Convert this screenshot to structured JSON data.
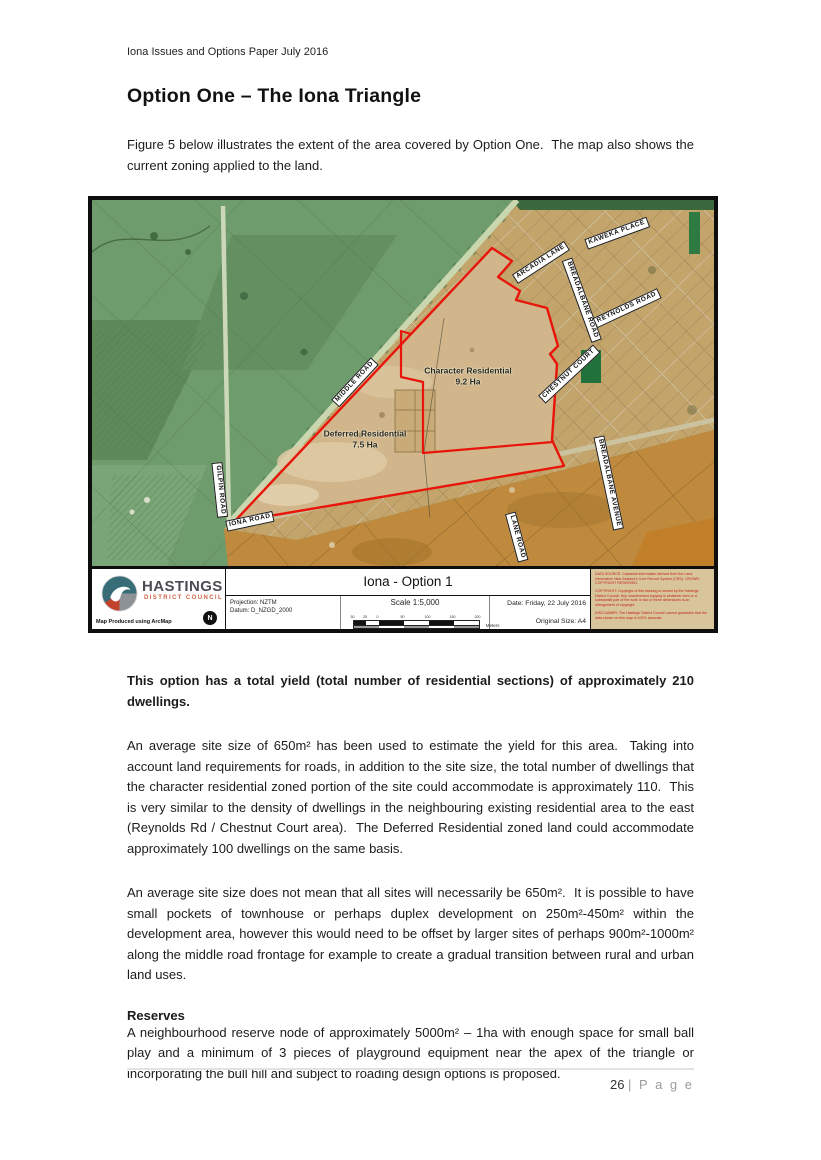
{
  "page": {
    "header": "Iona Issues and Options Paper July 2016",
    "title": "Option One – The Iona Triangle",
    "intro": "Figure 5 below illustrates the extent of the area covered by Option One.  The map also shows the current zoning applied to the land.",
    "footer": {
      "page_number": "26 ",
      "page_suffix": "| P a g e"
    }
  },
  "map": {
    "zone_labels": [
      {
        "name": "Character Residential",
        "area": "9.2 Ha"
      },
      {
        "name": "Deferred Residential",
        "area": "7.5 Ha"
      }
    ],
    "road_labels": [
      "MIDDLE ROAD",
      "GILPIN ROAD",
      "IONA ROAD",
      "LANE ROAD",
      "ARCADIA LANE",
      "KAWEKA PLACE",
      "BREADALBANE ROAD",
      "REYNOLDS ROAD",
      "CHESTNUT COURT",
      "BREADALBANE AVENUE"
    ],
    "footer": {
      "logo_title": "HASTINGS",
      "logo_subtitle": "DISTRICT COUNCIL",
      "produced": "Map Produced using ArcMap",
      "compass": "N",
      "projection": "Projection: NZTM",
      "datum": "Datum: D_NZGD_2000",
      "title": "Iona - Option 1",
      "scale": "Scale 1:5,000",
      "scale_ticks": [
        "50",
        "25",
        "0",
        "50",
        "100",
        "150",
        "200"
      ],
      "scale_units": "Meters",
      "date": "Date: Friday, 22 July 2016",
      "original_size": "Original Size: A4",
      "data_source": "DATA SOURCE: Cadastral information derived from the Land Information New Zealand's Core Record System (CRS). CROWN COPYRIGHT RESERVED.",
      "copyright": "COPYRIGHT: Copyright of this drawing is owned by the Hastings District Council. Any unauthorised copying in whatever form or a substantial part of the work in two or three dimensions is an infringement of copyright.",
      "disclaimer": "DISCLAIMER: The Hastings District Council cannot guarantee that the data shown on this map is 100% accurate."
    },
    "colors": {
      "rural_green": "#6f9c6c",
      "urban_tan": "#c3a46b",
      "triangle_fill": "#d2b68b",
      "rural_residential_orange": "#bf8a3e",
      "zone_outline_red": "#e8150b"
    }
  },
  "body": {
    "lead_bold": "This option has a total yield (total number of residential sections) of approximately 210 dwellings.",
    "para1": "An average site size of 650m² has been used to estimate the yield for this area.  Taking into account land requirements for roads, in addition to the site size, the total number of dwellings that the character residential zoned portion of the site could accommodate is approximately 110.  This is very similar to the density of dwellings in the neighbouring existing residential area to the east (Reynolds Rd / Chestnut Court area).  The Deferred Residential zoned land could accommodate approximately 100 dwellings on the same basis.",
    "para2": "An average site size does not mean that all sites will necessarily be 650m².  It is possible to have small pockets of townhouse or perhaps duplex development on 250m²-450m² within the development area, however this would need to be offset by larger sites of perhaps 900m²-1000m²  along the middle road frontage for example to create a gradual transition between rural and urban land uses.",
    "reserves_heading": "Reserves",
    "reserves_text": "A neighbourhood reserve node of approximately 5000m² – 1ha with enough space for small ball play and a minimum of 3 pieces of playground equipment near the apex of the triangle or incorporating the bull hill and subject to roading design options is proposed."
  }
}
